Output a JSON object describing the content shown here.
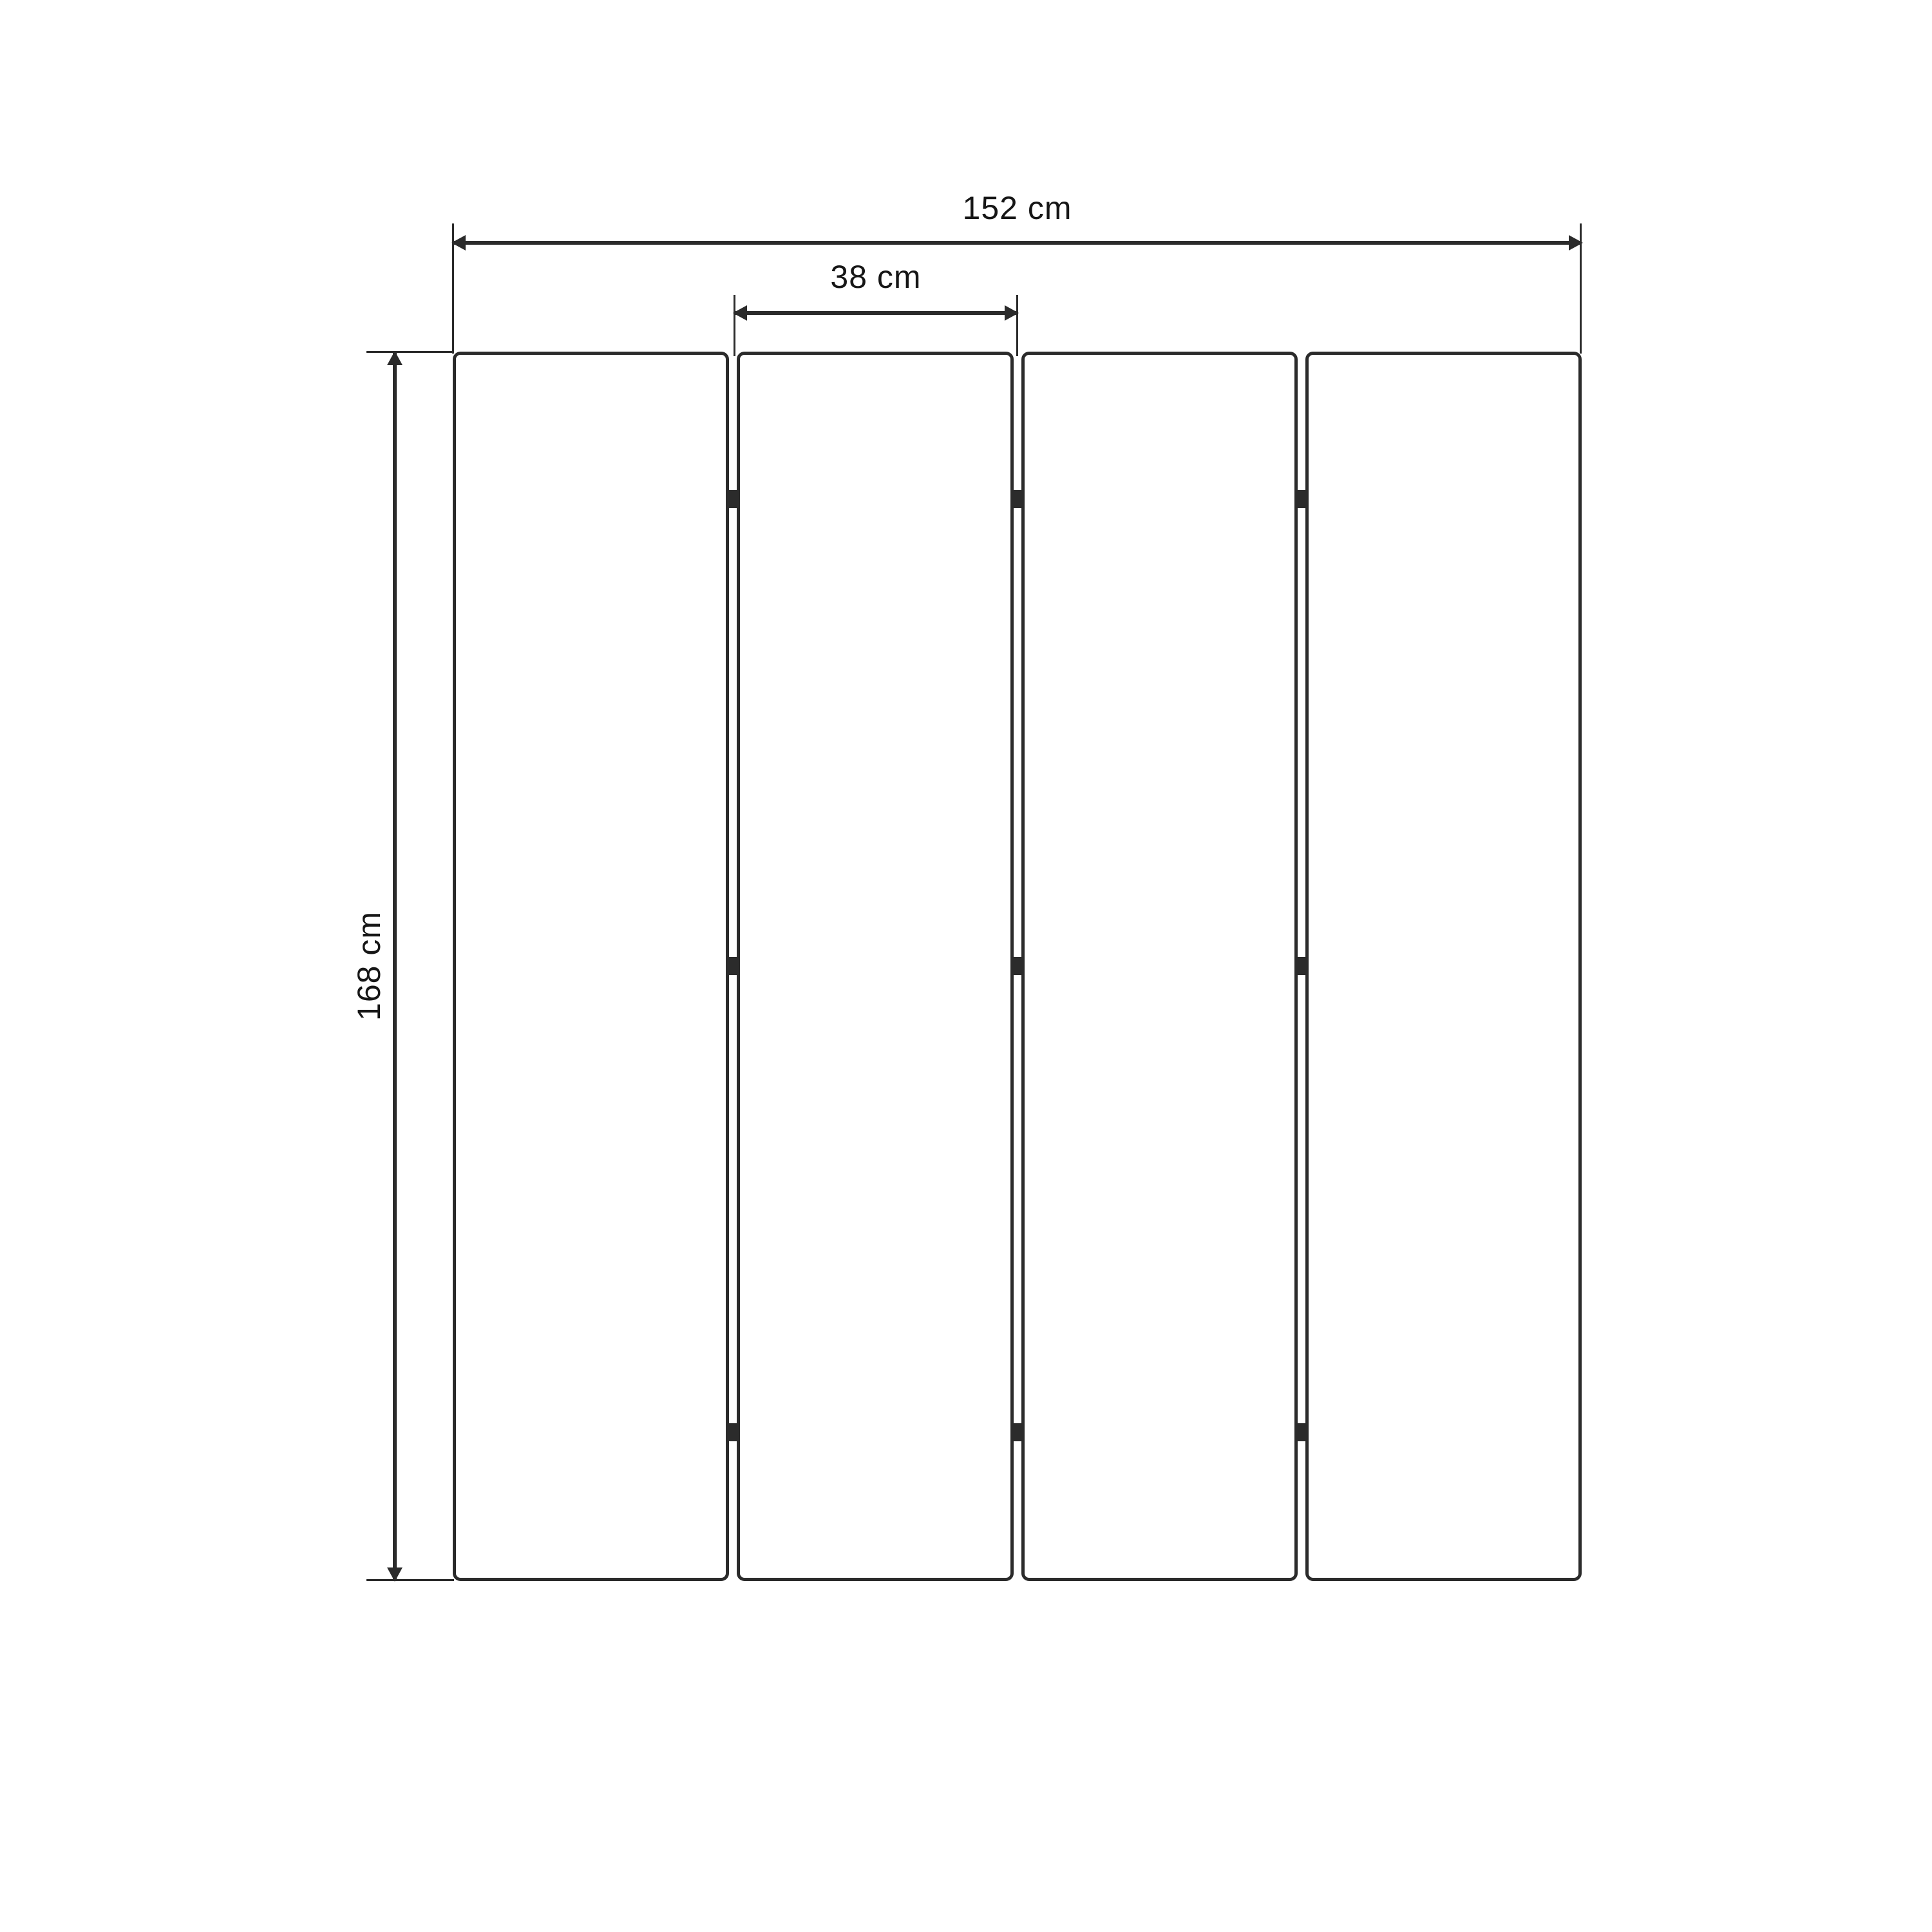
{
  "diagram": {
    "type": "dimension-drawing",
    "subject": "four-panel folding screen, front view"
  },
  "dimensions": {
    "total_width": {
      "label": "152 cm",
      "value_cm": 152,
      "orientation": "horizontal"
    },
    "panel_width": {
      "label": "38 cm",
      "value_cm": 38,
      "orientation": "horizontal"
    },
    "height": {
      "label": "168 cm",
      "value_cm": 168,
      "orientation": "vertical"
    }
  },
  "panels": {
    "count": 4,
    "hinge_rows": 3
  },
  "colors": {
    "line": "#2b2b2b",
    "text": "#161616",
    "background": "#ffffff"
  }
}
